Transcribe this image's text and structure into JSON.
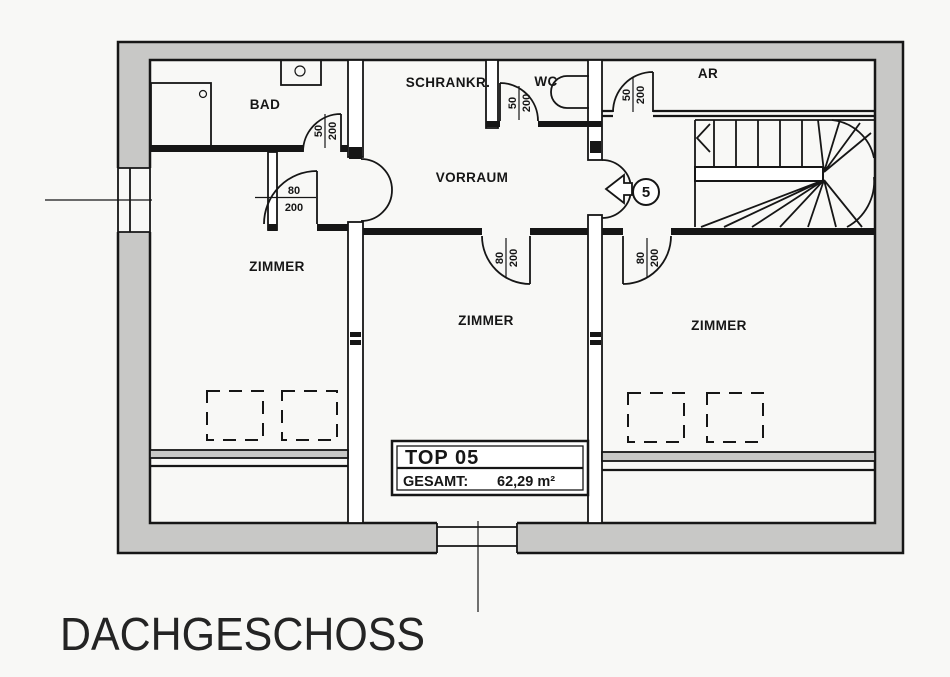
{
  "page": {
    "floor_title": "DACHGESCHOSS"
  },
  "info_box": {
    "unit": "TOP 05",
    "total_label": "GESAMT:",
    "total_value": "62,29 m²"
  },
  "entrance": {
    "unit_number": "5"
  },
  "rooms": [
    {
      "id": "bad",
      "label": "BAD"
    },
    {
      "id": "schrankraum",
      "label": "SCHRANKR."
    },
    {
      "id": "wc",
      "label": "WC"
    },
    {
      "id": "abstellraum",
      "label": "AR"
    },
    {
      "id": "vorraum",
      "label": "VORRAUM"
    },
    {
      "id": "zimmer-left",
      "label": "ZIMMER"
    },
    {
      "id": "zimmer-middle",
      "label": "ZIMMER"
    },
    {
      "id": "zimmer-right",
      "label": "ZIMMER"
    }
  ],
  "doors": [
    {
      "id": "bad-door",
      "width": "50",
      "height": "200"
    },
    {
      "id": "wc-door",
      "width": "50",
      "height": "200"
    },
    {
      "id": "ar-door",
      "width": "50",
      "height": "200"
    },
    {
      "id": "zimmer-left-door",
      "width": "80",
      "height": "200"
    },
    {
      "id": "zimmer-middle-door",
      "width": "80",
      "height": "200"
    },
    {
      "id": "zimmer-right-door",
      "width": "80",
      "height": "200"
    }
  ],
  "colors": {
    "wall_fill": "#c8c8c6",
    "line": "#161616",
    "paper": "#f8f8f6"
  }
}
